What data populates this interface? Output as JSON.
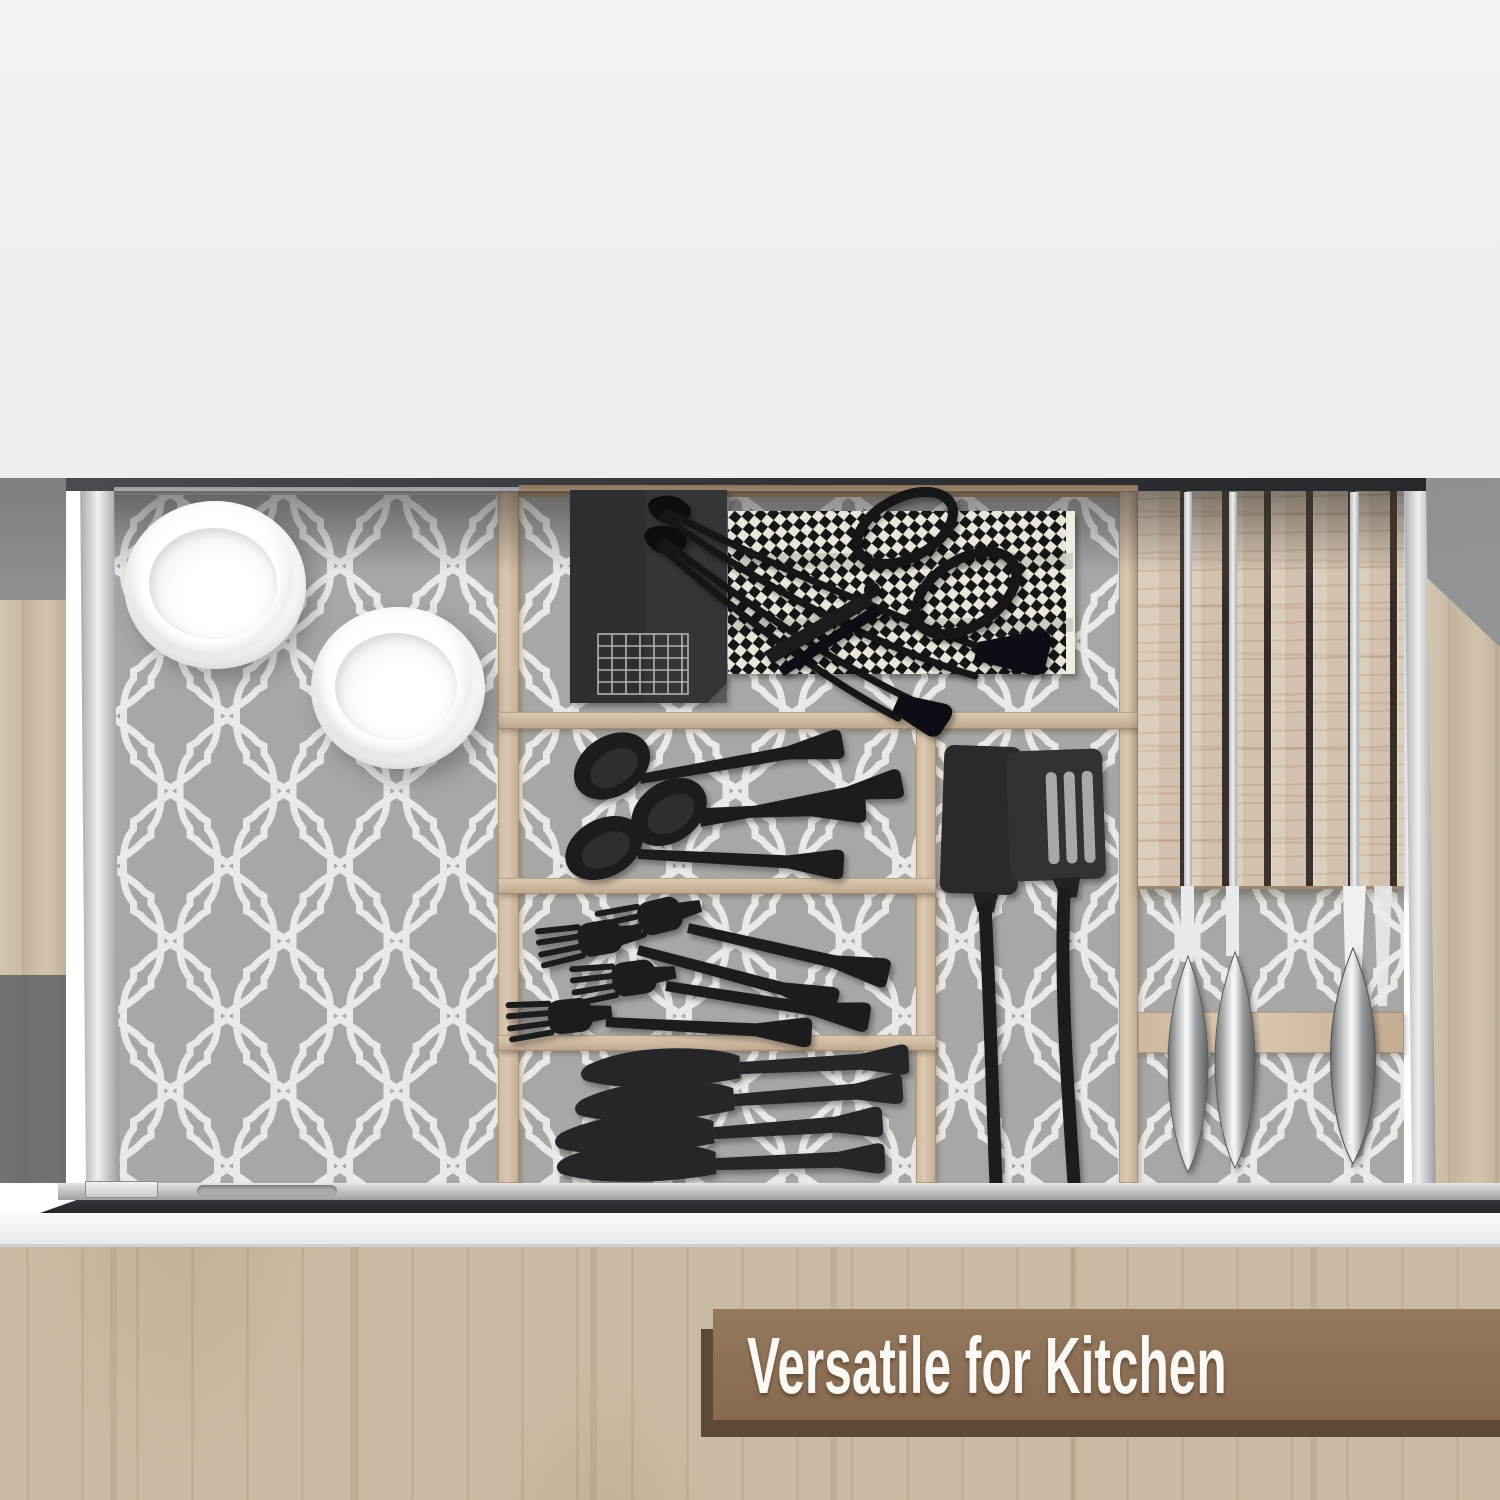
{
  "banner": {
    "label": "Versatile for Kitchen",
    "background_color": "#8c7157",
    "shadow_color": "#5e4936",
    "text_color": "#fbf9f5"
  },
  "scene": {
    "type": "product-photo",
    "subject": "open kitchen drawer with bamboo drawer organizers, top view",
    "liner_pattern": "gray quatrefoil lattice drawer liner",
    "liner_base_color": "#a7a7a5",
    "liner_motif_color": "#ebe9e5",
    "bamboo_color": "#d2bfa6",
    "drawer_front_color": "#f4f5f6",
    "cabinet_wood_color": "#cabca4",
    "wall_color": "#f1f1f2"
  },
  "contents": {
    "bowls": 2,
    "black_spoons": 4,
    "black_forks": 4,
    "black_table_knives": 4,
    "black_spatulas": 2,
    "tongs": 2,
    "scissors": 1,
    "houndstooth_towel": 1,
    "knife_block_knives": 3
  }
}
